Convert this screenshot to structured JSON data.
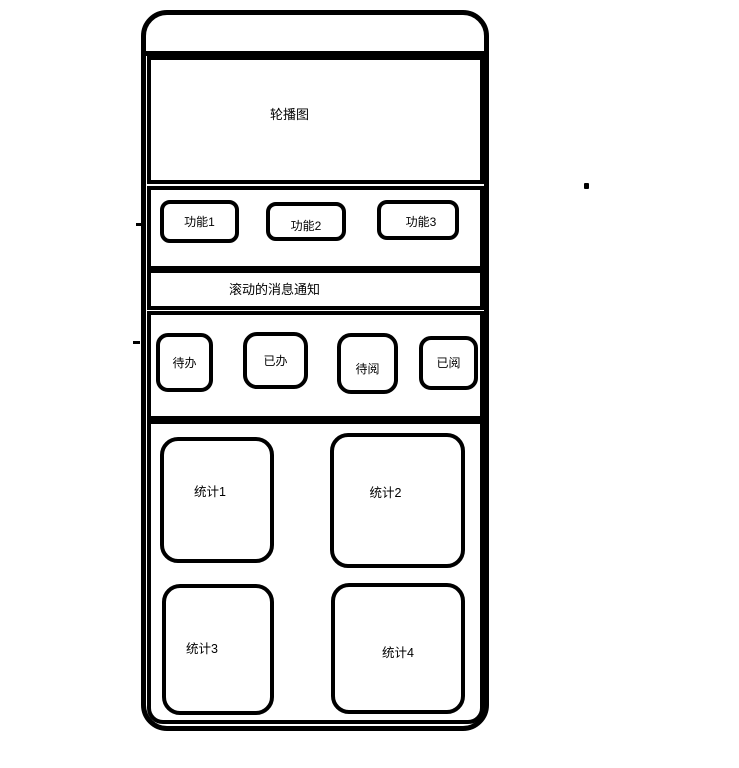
{
  "colors": {
    "background": "#ffffff",
    "line": "#000000",
    "text": "#000000"
  },
  "phone": {
    "carousel": {
      "label": "轮播图"
    },
    "functions": [
      {
        "label": "功能1"
      },
      {
        "label": "功能2"
      },
      {
        "label": "功能3"
      }
    ],
    "notice": {
      "label": "滚动的消息通知"
    },
    "badges": [
      {
        "label": "待办"
      },
      {
        "label": "已办"
      },
      {
        "label": "待阅"
      },
      {
        "label": "已阅"
      }
    ],
    "stats": [
      {
        "label": "统计1"
      },
      {
        "label": "统计2"
      },
      {
        "label": "统计3"
      },
      {
        "label": "统计4"
      }
    ]
  }
}
